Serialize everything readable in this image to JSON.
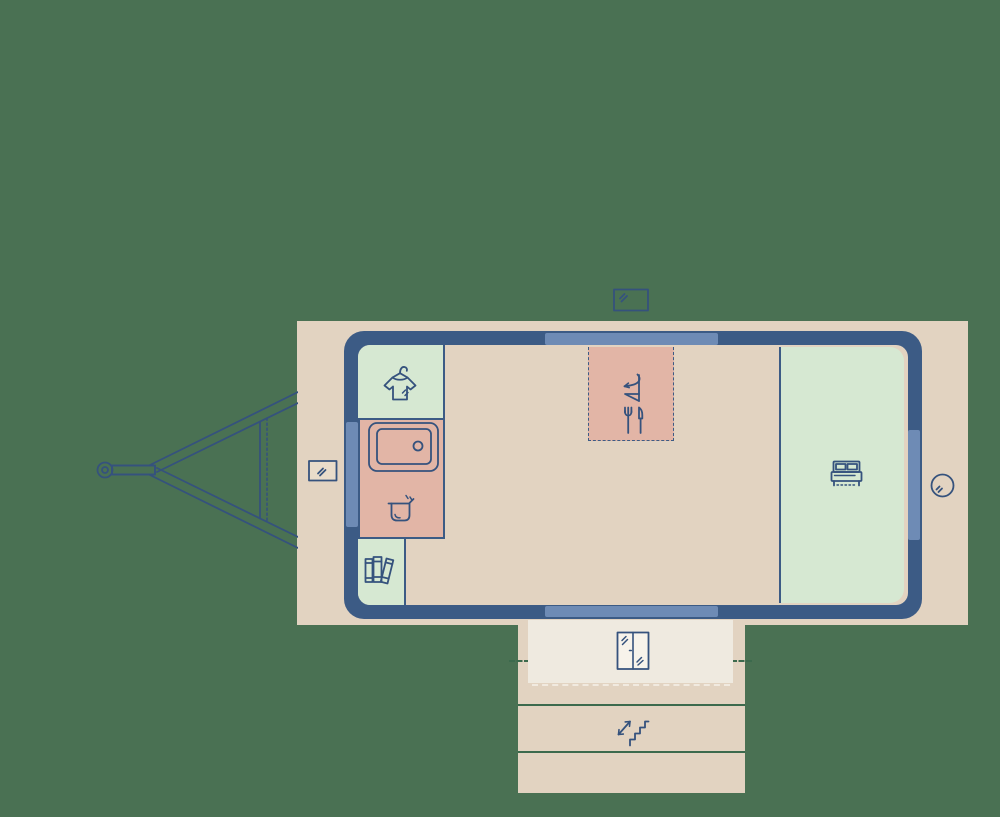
{
  "app": {
    "title": "Tiny house trailer floor plan"
  },
  "palette": {
    "background": "#4a7153",
    "pad": "#e2d3c1",
    "wall": "#3c5b85",
    "window": "#6e8bb5",
    "room_green": "#d6e8d2",
    "room_pink": "#e2b5a6",
    "landing_cream": "#efeae0",
    "door_fill": "#f7f3eb",
    "icon_stroke": "#35527d",
    "symbol_stroke": "#47628e",
    "deck_line_green": "#3c6a4d",
    "window_symbol_fill": "#e9dcca"
  },
  "floorplan": {
    "trailer": {
      "shape": "rounded rectangle shell with tow hitch on the left",
      "windows": [
        "top-wall-window",
        "bottom-wall-window",
        "left-wall-window",
        "right-wall-window"
      ]
    },
    "rooms": [
      {
        "id": "wardrobe",
        "zone_color": "room_green",
        "icon": "tshirt-hanger-icon"
      },
      {
        "id": "kitchen-counter",
        "zone_color": "room_pink",
        "icon": "sink-icon"
      },
      {
        "id": "cooktop",
        "zone_color": "room_pink",
        "icon": "cooking-pot-icon"
      },
      {
        "id": "bookshelf",
        "zone_color": "room_green",
        "icon": "books-icon"
      },
      {
        "id": "fold-down-table",
        "zone_color": "room_pink",
        "icon": "drop-table-icon",
        "border": "dashed"
      },
      {
        "id": "dining-spot",
        "zone_color": "room_pink",
        "icon": "fork-knife-icon"
      },
      {
        "id": "bedroom",
        "zone_color": "room_green",
        "icon": "double-bed-icon"
      }
    ],
    "exterior": [
      {
        "id": "tow-hitch",
        "icon": "hitch-drawbar"
      },
      {
        "id": "window-symbol-top",
        "icon": "window-symbol-icon"
      },
      {
        "id": "window-symbol-left",
        "icon": "window-symbol-icon"
      },
      {
        "id": "porthole",
        "icon": "porthole-icon"
      },
      {
        "id": "entry-landing",
        "icon": "double-door-icon"
      },
      {
        "id": "deck-steps",
        "icon": "stairs-icon"
      }
    ]
  }
}
